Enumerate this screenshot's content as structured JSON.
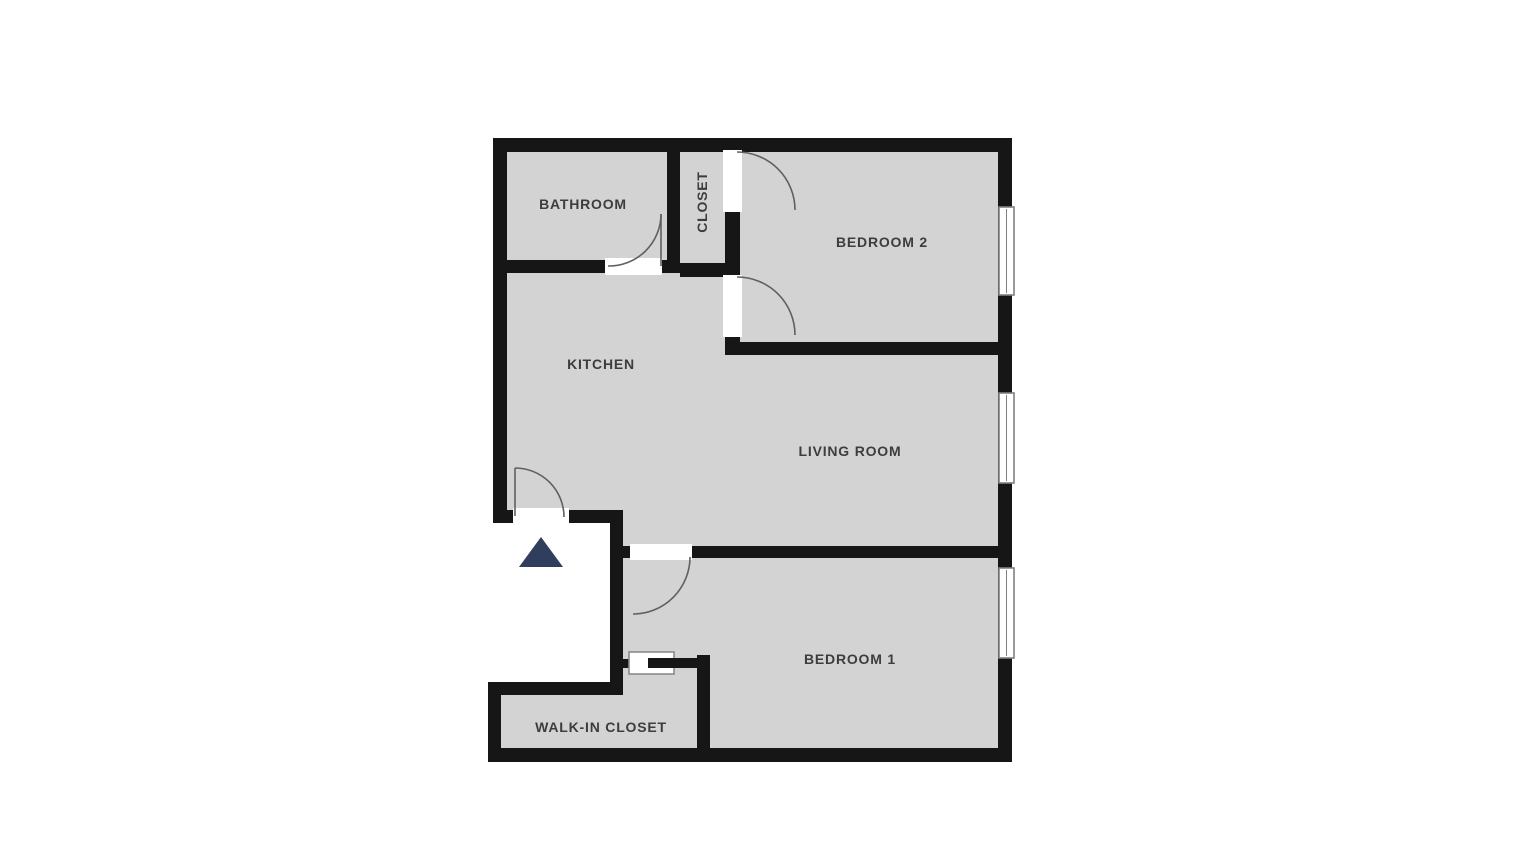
{
  "floor_plan": {
    "rooms": {
      "bathroom": {
        "label": "BATHROOM"
      },
      "closet": {
        "label": "CLOSET"
      },
      "bedroom_2": {
        "label": "BEDROOM 2"
      },
      "kitchen": {
        "label": "KITCHEN"
      },
      "living_room": {
        "label": "LIVING ROOM"
      },
      "bedroom_1": {
        "label": "BEDROOM 1"
      },
      "walk_in_closet": {
        "label": "WALK-IN CLOSET"
      }
    },
    "icons": {
      "entrance_marker": "triangle-up"
    },
    "counts": {
      "windows": 3,
      "swing_doors": 5,
      "sliding_doors": 1
    }
  },
  "colors": {
    "background": "#ffffff",
    "floor": "#d3d3d3",
    "wall": "#161616",
    "label": "#3d3d3d",
    "door": "#606060",
    "window_border": "#808080",
    "entrance_marker": "#2e3e5c"
  }
}
